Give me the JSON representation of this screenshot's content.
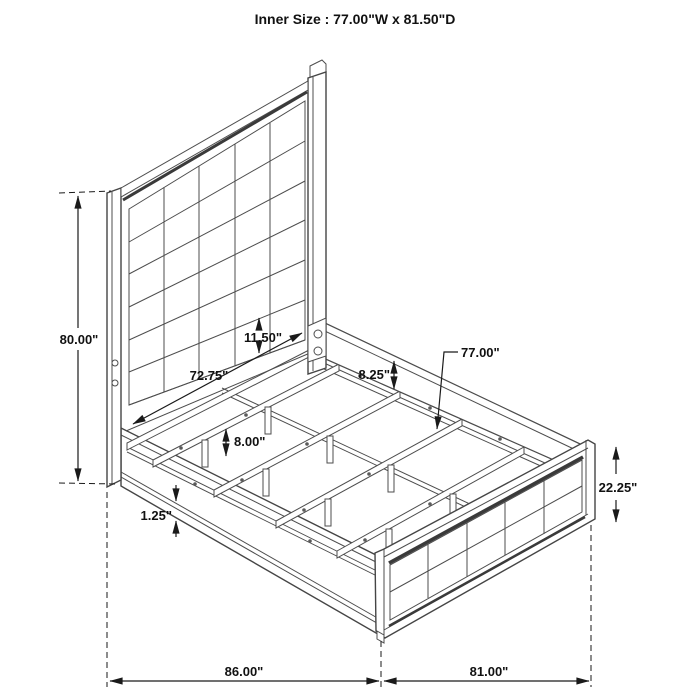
{
  "title": "Inner Size : 77.00\"W x 81.50\"D",
  "dimensions": {
    "headboard_height": "80.00\"",
    "headboard_inner_width": "72.75\"",
    "headboard_panel_bottom": "11.50\"",
    "side_rail_height": "8.25\"",
    "slat_width": "77.00\"",
    "slat_leg_height": "8.00\"",
    "rail_trim_height": "1.25\"",
    "footboard_height": "22.25\"",
    "overall_depth": "86.00\"",
    "overall_width": "81.00\""
  },
  "colors": {
    "background": "#ffffff",
    "drawing_line": "#4d4d4d",
    "accent_dark": "#3a3a3a",
    "dimension_line": "#1a1a1a",
    "text": "#111111"
  }
}
